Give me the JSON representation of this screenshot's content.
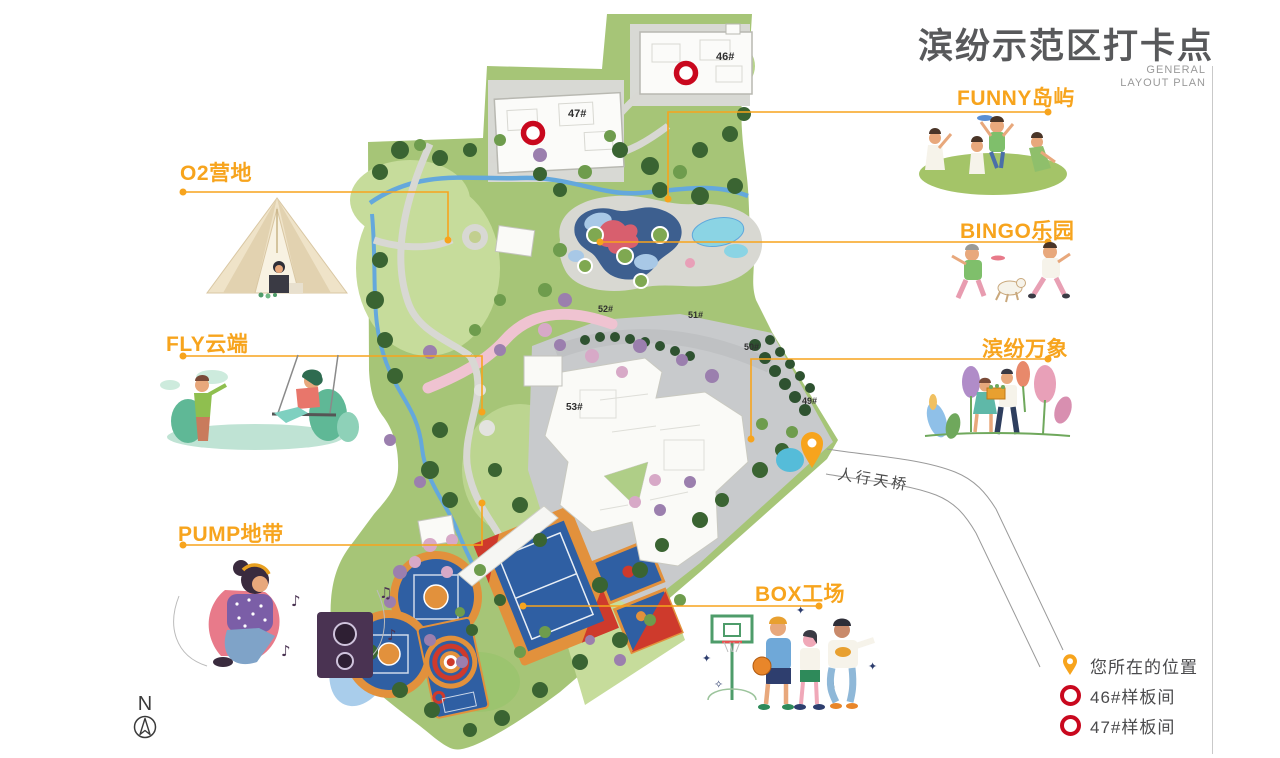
{
  "header": {
    "title": "滨纷示范区打卡点",
    "subtitle": [
      "GENERAL",
      "LAYOUT PLAN"
    ]
  },
  "pois": [
    {
      "label": "O2营地"
    },
    {
      "label": "FLY云端"
    },
    {
      "label": "PUMP地带"
    },
    {
      "label": "FUNNY岛屿"
    },
    {
      "label": "BINGO乐园"
    },
    {
      "label": "滨纷万象"
    },
    {
      "label": "BOX工场"
    }
  ],
  "map": {
    "bridge_label": "人行天桥",
    "building_labels": {
      "b46": "46#",
      "b47": "47#",
      "b49": "49#",
      "b50": "50#",
      "b51": "51#",
      "b52": "52#",
      "b53": "53#"
    }
  },
  "legend": {
    "items": [
      {
        "icon": "location-pin-icon",
        "label": "您所在的位置"
      },
      {
        "icon": "red-ring-icon",
        "label": "46#样板间"
      },
      {
        "icon": "red-ring-icon",
        "label": "47#样板间"
      }
    ]
  },
  "compass": {
    "label": "N"
  },
  "colors": {
    "accent": "#F7A41D",
    "legend_red": "#C9081E",
    "title_gray": "#58595B"
  }
}
